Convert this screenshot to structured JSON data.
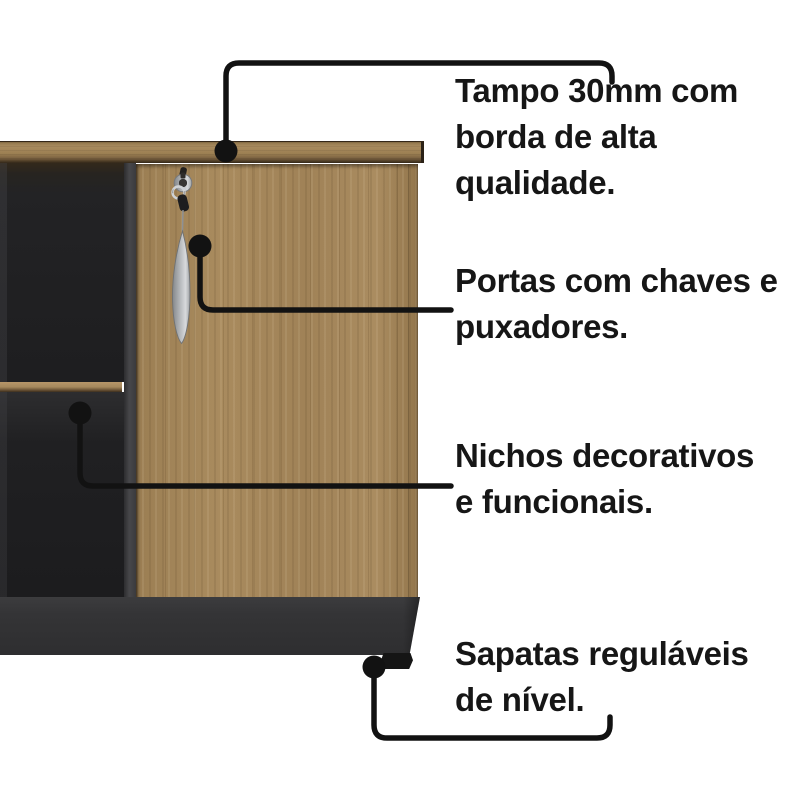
{
  "annotations": [
    {
      "id": "tampo",
      "target": "cabinet-top",
      "lines": [
        "Tampo 30mm com",
        "borda de alta",
        "qualidade."
      ]
    },
    {
      "id": "portas",
      "target": "door-lock-handle",
      "lines": [
        "Portas com chaves e",
        "puxadores."
      ]
    },
    {
      "id": "nichos",
      "target": "open-niche",
      "lines": [
        "Nichos decorativos",
        "e funcionais."
      ]
    },
    {
      "id": "sapatas",
      "target": "adjustable-foot",
      "lines": [
        "Sapatas reguláveis",
        "de nível."
      ]
    }
  ],
  "colors": {
    "background": "#ffffff",
    "text": "#161616",
    "callout_line": "#121212",
    "wood": "#a5875a",
    "wood_edge_dark": "#4a3a25",
    "interior_dark": "#202022",
    "divider_gray": "#424245",
    "base_gray": "#333335",
    "metal_silver": "#b9bcc0",
    "foot_black": "#151515"
  }
}
